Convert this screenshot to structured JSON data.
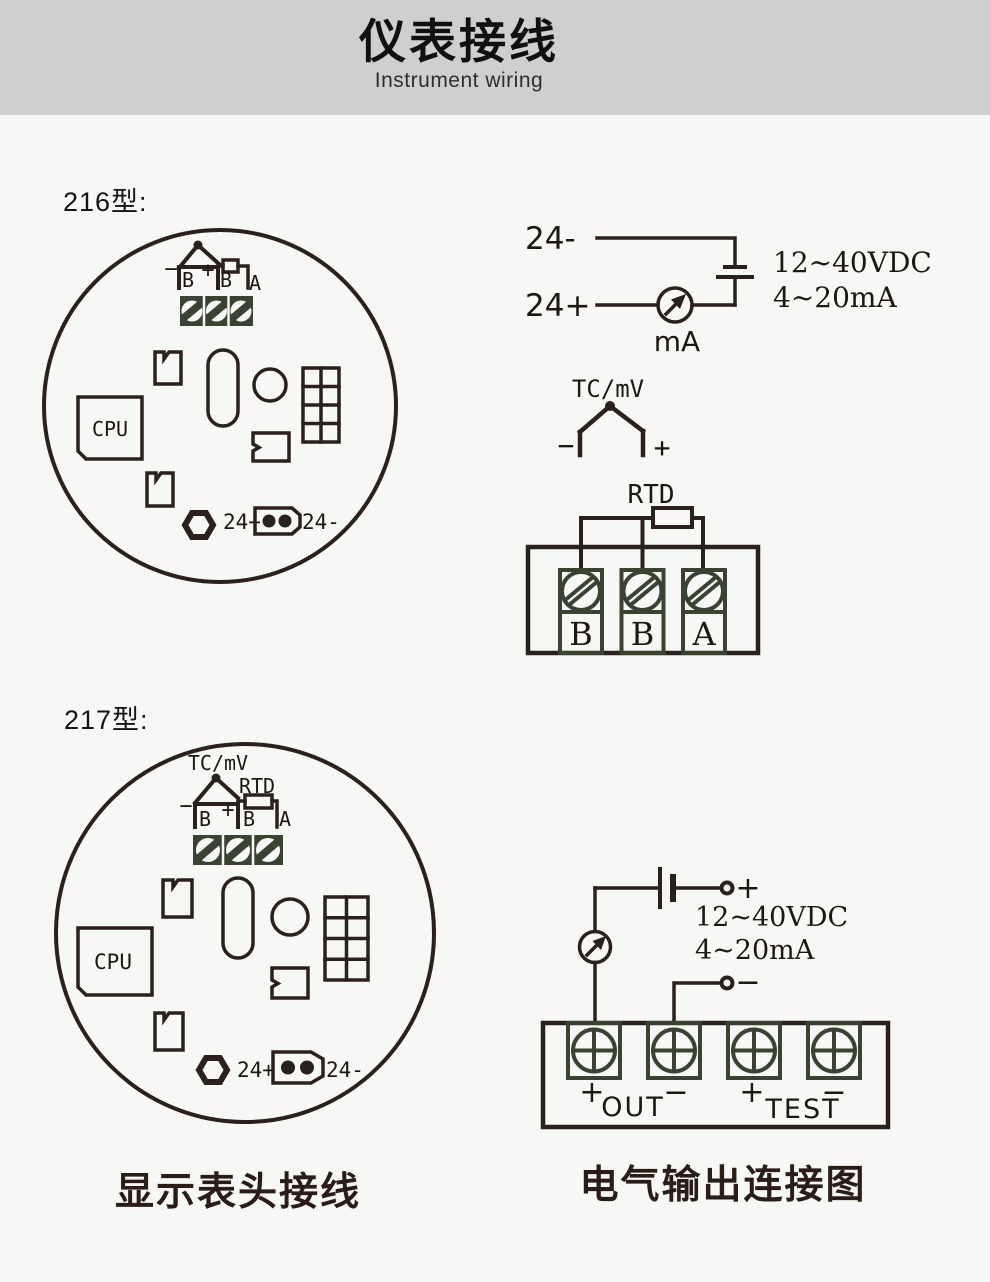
{
  "header": {
    "title": "仪表接线",
    "subtitle": "Instrument wiring"
  },
  "model216": {
    "label": "216型:",
    "board": {
      "cpu": "CPU",
      "minus": "−",
      "plus": "+",
      "terminals": [
        "B",
        "B",
        "A"
      ],
      "power_plus": "24+",
      "power_minus": "24-"
    },
    "loop": {
      "supply_minus": "24-",
      "supply_plus": "24+",
      "meter": "mA",
      "voltage_range": "12~40VDC",
      "current_range": "4~20mA"
    },
    "tc": {
      "label": "TC/mV",
      "minus": "−",
      "plus": "+"
    },
    "rtd": {
      "label": "RTD",
      "terminals": [
        "B",
        "B",
        "A"
      ]
    }
  },
  "model217": {
    "label": "217型:",
    "board": {
      "tc_label": "TC/mV",
      "rtd_label": "RTD",
      "cpu": "CPU",
      "minus": "−",
      "plus": "+",
      "terminals": [
        "B",
        "B",
        "A"
      ],
      "power_plus": "24+",
      "power_minus": "24-"
    },
    "output": {
      "supply_plus": "+",
      "supply_minus": "−",
      "voltage_range": "12~40VDC",
      "current_range": "4~20mA",
      "out_plus": "+",
      "out_label": "OUT",
      "out_minus": "−",
      "test_plus": "+",
      "test_label": "TEST",
      "test_minus": "−"
    }
  },
  "captions": {
    "meter_wiring": "显示表头接线",
    "output_wiring": "电气输出连接图"
  }
}
